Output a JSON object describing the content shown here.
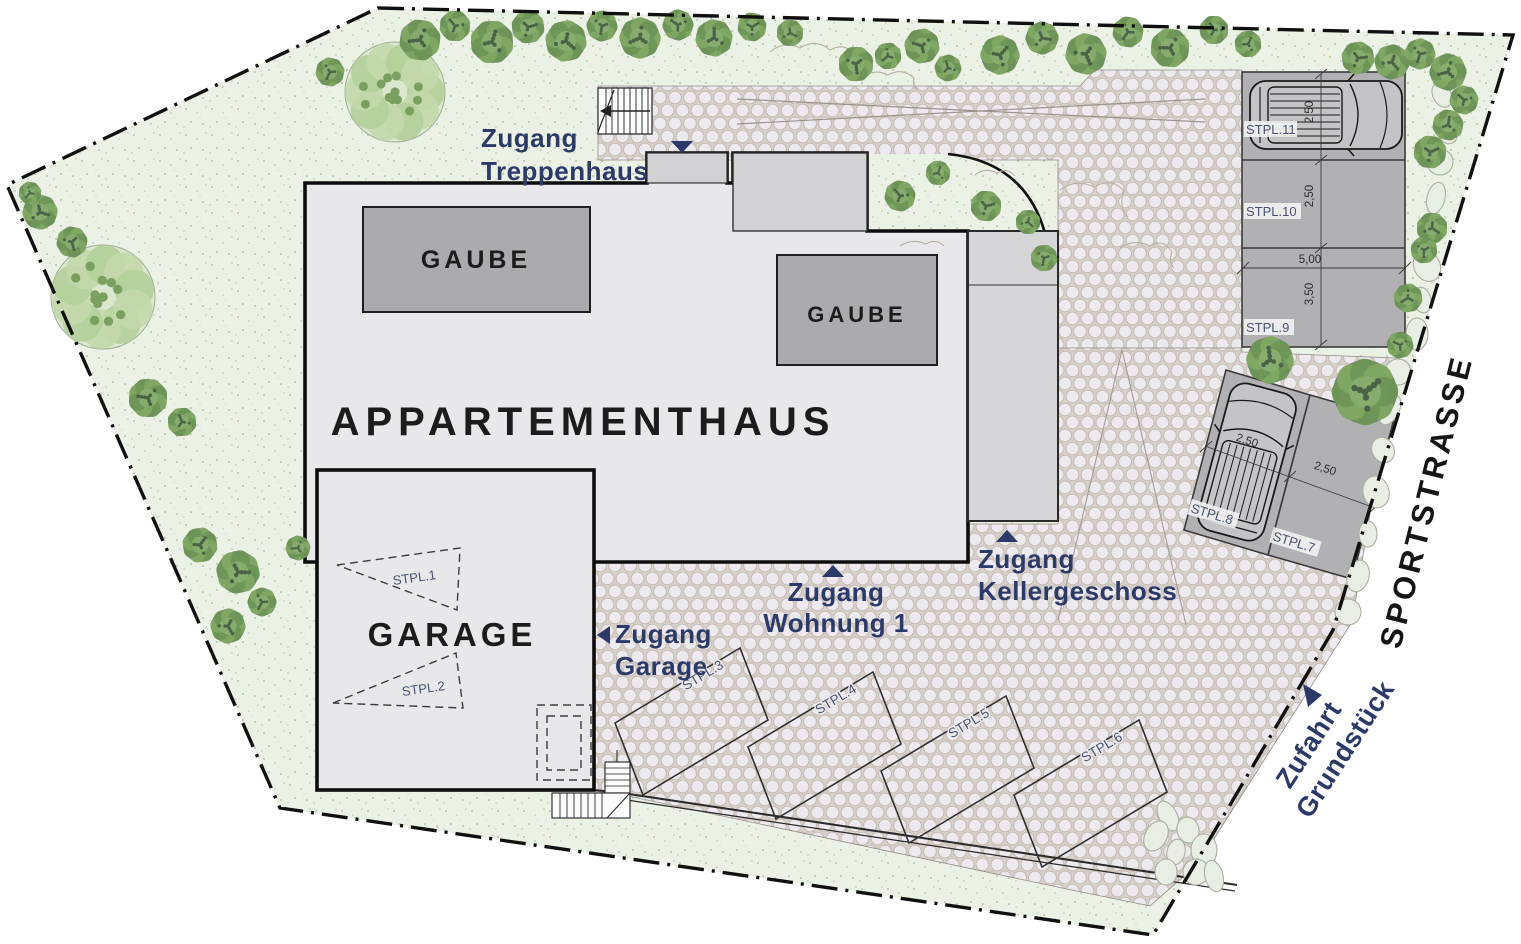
{
  "plan": {
    "title": "APPARTEMENTHAUS",
    "garage_label": "GARAGE",
    "gaube_label": "GAUBE",
    "street": "SPORTSTRASSE",
    "access": {
      "treppenhaus": [
        "Zugang",
        "Treppenhaus"
      ],
      "wohnung": [
        "Zugang",
        "Wohnung 1"
      ],
      "keller": [
        "Zugang",
        "Kellergeschoss"
      ],
      "garage": [
        "Zugang",
        "Garage"
      ],
      "zufahrt": [
        "Zufahrt",
        "Grundstück"
      ]
    },
    "stalls": {
      "s1": "STPL.1",
      "s2": "STPL.2",
      "s3": "STPL.3",
      "s4": "STPL.4",
      "s5": "STPL.5",
      "s6": "STPL.6",
      "s7": "STPL.7",
      "s8": "STPL.8",
      "s9": "STPL.9",
      "s10": "STPL.10",
      "s11": "STPL.11"
    },
    "dims": {
      "w250": "2,50",
      "w500": "5,00",
      "w350": "3,50"
    },
    "colors": {
      "navy": "#2c3a6a",
      "stall_gray": "#b1b1b4",
      "building_gray": "#e8e8ea",
      "annex_gray": "#d2d2d5",
      "lawn_green": "#ecf1e5",
      "tree_green": "#6d9556"
    }
  }
}
